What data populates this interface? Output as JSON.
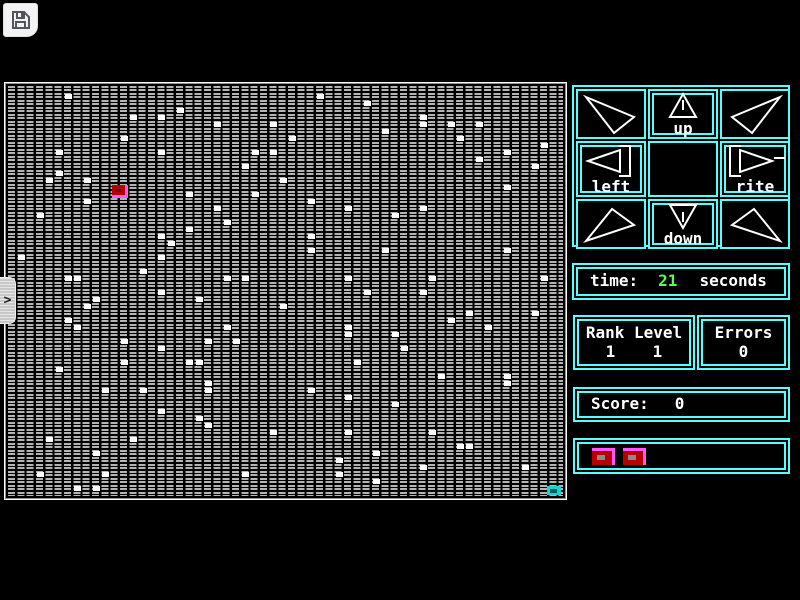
{
  "colors": {
    "panel_border": "#55ffff",
    "text": "#ffffff",
    "time_value": "#55ff55",
    "grid_cell": "#b4b4b4",
    "player": "#b40000",
    "player_highlight": "#ff55ff",
    "target": "#1bd2d2",
    "life": "#b40000",
    "life_highlight": "#ff55ff"
  },
  "toolbar": {
    "save_icon": "floppy-disk"
  },
  "side_tab": {
    "glyph": ">"
  },
  "control_pad": {
    "buttons": [
      {
        "id": "up-left",
        "label": "",
        "glyph": "arrow-up-left",
        "highlighted": false
      },
      {
        "id": "up",
        "label": "up",
        "glyph": "arrow-up",
        "highlighted": true
      },
      {
        "id": "up-right",
        "label": "",
        "glyph": "arrow-up-right",
        "highlighted": false
      },
      {
        "id": "left",
        "label": "left",
        "glyph": "arrow-left",
        "highlighted": true
      },
      {
        "id": "center",
        "label": "",
        "glyph": "",
        "highlighted": false
      },
      {
        "id": "rite",
        "label": "rite",
        "glyph": "arrow-right",
        "highlighted": true
      },
      {
        "id": "down-left",
        "label": "",
        "glyph": "arrow-down-left",
        "highlighted": false
      },
      {
        "id": "down",
        "label": "down",
        "glyph": "arrow-down",
        "highlighted": true
      },
      {
        "id": "down-right",
        "label": "",
        "glyph": "arrow-down-right",
        "highlighted": false
      }
    ]
  },
  "status": {
    "time_label": "time:",
    "time_value": "21",
    "time_unit": "seconds",
    "rank_level_label": "Rank Level",
    "rank_value": "1",
    "level_value": "1",
    "errors_label": "Errors",
    "errors_value": "0",
    "score_label": "Score:",
    "score_value": "0",
    "lives_count": 2
  },
  "playfield": {
    "grid_cols": 60,
    "grid_rows": 59,
    "cell_pitch_x": 9.3333,
    "cell_pitch_y": 7,
    "player": {
      "col": 11,
      "row": 14
    },
    "target": {
      "col": 58,
      "row": 57
    },
    "dots": [
      [
        6,
        1
      ],
      [
        33,
        1
      ],
      [
        38,
        2
      ],
      [
        18,
        3
      ],
      [
        13,
        4
      ],
      [
        16,
        4
      ],
      [
        44,
        4
      ],
      [
        22,
        5
      ],
      [
        28,
        5
      ],
      [
        44,
        5
      ],
      [
        47,
        5
      ],
      [
        50,
        5
      ],
      [
        40,
        6
      ],
      [
        12,
        7
      ],
      [
        30,
        7
      ],
      [
        48,
        7
      ],
      [
        57,
        8
      ],
      [
        5,
        9
      ],
      [
        16,
        9
      ],
      [
        26,
        9
      ],
      [
        28,
        9
      ],
      [
        53,
        9
      ],
      [
        50,
        10
      ],
      [
        25,
        11
      ],
      [
        56,
        11
      ],
      [
        5,
        12
      ],
      [
        4,
        13
      ],
      [
        8,
        13
      ],
      [
        29,
        13
      ],
      [
        53,
        14
      ],
      [
        19,
        15
      ],
      [
        26,
        15
      ],
      [
        8,
        16
      ],
      [
        32,
        16
      ],
      [
        22,
        17
      ],
      [
        36,
        17
      ],
      [
        44,
        17
      ],
      [
        3,
        18
      ],
      [
        41,
        18
      ],
      [
        23,
        19
      ],
      [
        19,
        20
      ],
      [
        16,
        21
      ],
      [
        32,
        21
      ],
      [
        17,
        22
      ],
      [
        32,
        23
      ],
      [
        40,
        23
      ],
      [
        53,
        23
      ],
      [
        1,
        24
      ],
      [
        16,
        24
      ],
      [
        14,
        26
      ],
      [
        6,
        27
      ],
      [
        7,
        27
      ],
      [
        23,
        27
      ],
      [
        25,
        27
      ],
      [
        36,
        27
      ],
      [
        45,
        27
      ],
      [
        57,
        27
      ],
      [
        16,
        29
      ],
      [
        38,
        29
      ],
      [
        44,
        29
      ],
      [
        9,
        30
      ],
      [
        20,
        30
      ],
      [
        8,
        31
      ],
      [
        29,
        31
      ],
      [
        49,
        32
      ],
      [
        56,
        32
      ],
      [
        6,
        33
      ],
      [
        47,
        33
      ],
      [
        7,
        34
      ],
      [
        23,
        34
      ],
      [
        36,
        34
      ],
      [
        51,
        34
      ],
      [
        36,
        35
      ],
      [
        41,
        35
      ],
      [
        12,
        36
      ],
      [
        21,
        36
      ],
      [
        24,
        36
      ],
      [
        16,
        37
      ],
      [
        42,
        37
      ],
      [
        12,
        39
      ],
      [
        19,
        39
      ],
      [
        20,
        39
      ],
      [
        37,
        39
      ],
      [
        5,
        40
      ],
      [
        46,
        41
      ],
      [
        53,
        41
      ],
      [
        21,
        42
      ],
      [
        53,
        42
      ],
      [
        10,
        43
      ],
      [
        14,
        43
      ],
      [
        21,
        43
      ],
      [
        32,
        43
      ],
      [
        36,
        44
      ],
      [
        41,
        45
      ],
      [
        16,
        46
      ],
      [
        20,
        47
      ],
      [
        21,
        48
      ],
      [
        28,
        49
      ],
      [
        36,
        49
      ],
      [
        45,
        49
      ],
      [
        4,
        50
      ],
      [
        13,
        50
      ],
      [
        48,
        51
      ],
      [
        49,
        51
      ],
      [
        9,
        52
      ],
      [
        39,
        52
      ],
      [
        35,
        53
      ],
      [
        44,
        54
      ],
      [
        55,
        54
      ],
      [
        3,
        55
      ],
      [
        10,
        55
      ],
      [
        25,
        55
      ],
      [
        35,
        55
      ],
      [
        39,
        56
      ],
      [
        7,
        57
      ],
      [
        9,
        57
      ]
    ]
  }
}
